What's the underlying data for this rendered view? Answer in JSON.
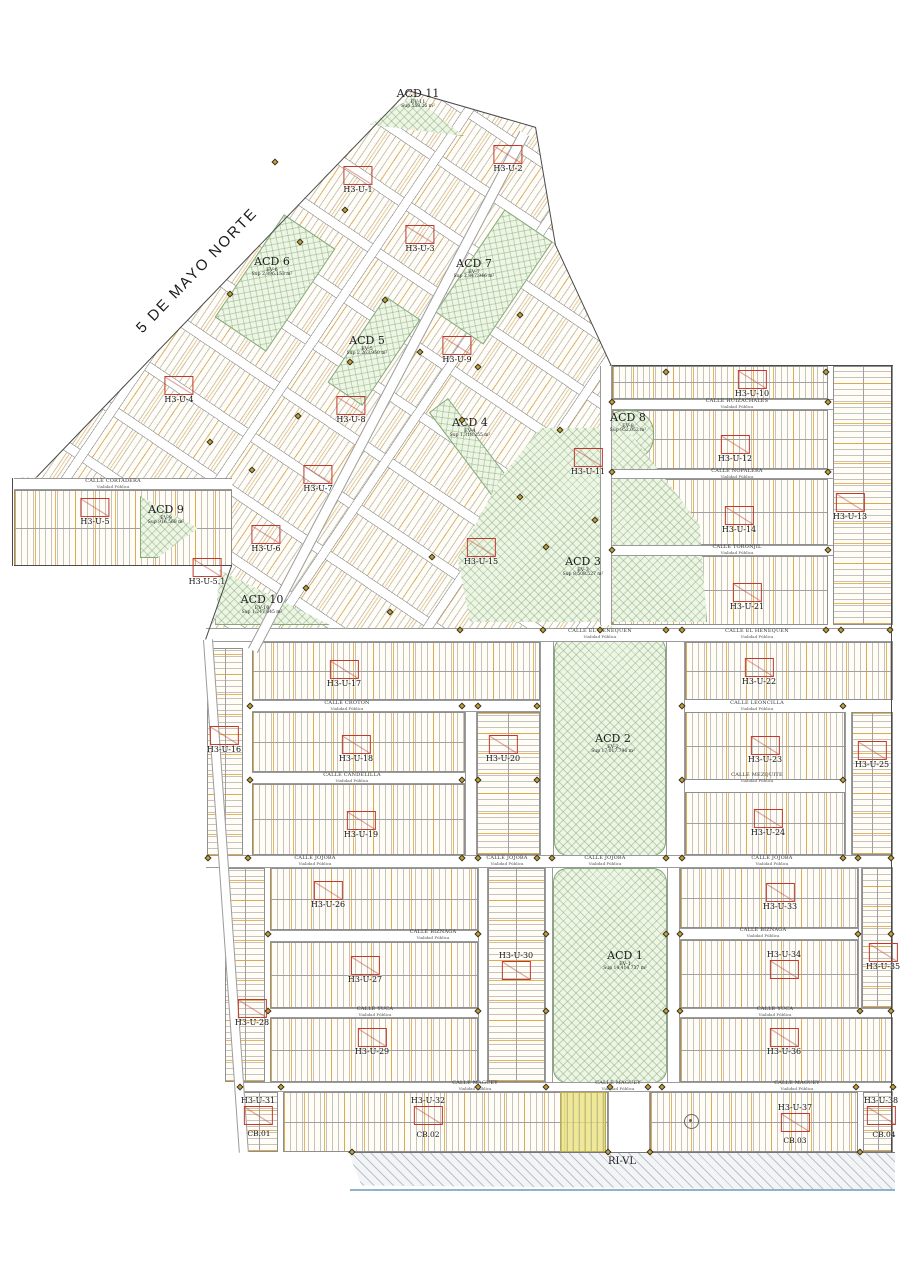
{
  "map": {
    "main_road_label": "5 DE MAYO NORTE",
    "zone_label": "RI-VL",
    "street_sub": "Vialidad Pública",
    "colors": {
      "marker_red": "#c0392b",
      "green_fill": "#edf5e4",
      "lot_orange": "#e0a33c",
      "survey_gold": "#c9a22c"
    }
  },
  "markers": [
    {
      "label": "H3-U-1",
      "x": 358,
      "y": 166,
      "p": "b"
    },
    {
      "label": "H3-U-2",
      "x": 508,
      "y": 145,
      "p": "b"
    },
    {
      "label": "H3-U-3",
      "x": 420,
      "y": 225,
      "p": "b"
    },
    {
      "label": "H3-U-4",
      "x": 179,
      "y": 376,
      "p": "b"
    },
    {
      "label": "H3-U-5",
      "x": 95,
      "y": 498,
      "p": "b"
    },
    {
      "label": "H3-U-5.1",
      "x": 207,
      "y": 558,
      "p": "b"
    },
    {
      "label": "H3-U-6",
      "x": 266,
      "y": 525,
      "p": "b"
    },
    {
      "label": "H3-U-7",
      "x": 318,
      "y": 465,
      "p": "b"
    },
    {
      "label": "H3-U-8",
      "x": 351,
      "y": 396,
      "p": "b"
    },
    {
      "label": "H3-U-9",
      "x": 457,
      "y": 336,
      "p": "b"
    },
    {
      "label": "H3-U-10",
      "x": 752,
      "y": 370,
      "p": "b"
    },
    {
      "label": "H3-U-11",
      "x": 588,
      "y": 448,
      "p": "b"
    },
    {
      "label": "H3-U-12",
      "x": 735,
      "y": 435,
      "p": "b"
    },
    {
      "label": "H3-U-13",
      "x": 850,
      "y": 493,
      "p": "b"
    },
    {
      "label": "H3-U-14",
      "x": 739,
      "y": 506,
      "p": "b"
    },
    {
      "label": "H3-U-15",
      "x": 481,
      "y": 538,
      "p": "b"
    },
    {
      "label": "H3-U-16",
      "x": 224,
      "y": 726,
      "p": "b"
    },
    {
      "label": "H3-U-17",
      "x": 344,
      "y": 660,
      "p": "b"
    },
    {
      "label": "H3-U-18",
      "x": 356,
      "y": 735,
      "p": "b"
    },
    {
      "label": "H3-U-19",
      "x": 361,
      "y": 811,
      "p": "b"
    },
    {
      "label": "H3-U-20",
      "x": 503,
      "y": 735,
      "p": "b"
    },
    {
      "label": "H3-U-21",
      "x": 747,
      "y": 583,
      "p": "b"
    },
    {
      "label": "H3-U-22",
      "x": 759,
      "y": 658,
      "p": "b"
    },
    {
      "label": "H3-U-23",
      "x": 765,
      "y": 736,
      "p": "b"
    },
    {
      "label": "H3-U-24",
      "x": 768,
      "y": 809,
      "p": "b"
    },
    {
      "label": "H3-U-25",
      "x": 872,
      "y": 741,
      "p": "b"
    },
    {
      "label": "H3-U-26",
      "x": 328,
      "y": 881,
      "p": "b"
    },
    {
      "label": "H3-U-27",
      "x": 365,
      "y": 956,
      "p": "b"
    },
    {
      "label": "H3-U-28",
      "x": 252,
      "y": 999,
      "p": "b"
    },
    {
      "label": "H3-U-29",
      "x": 372,
      "y": 1028,
      "p": "b"
    },
    {
      "label": "H3-U-30",
      "x": 516,
      "y": 963,
      "p": "a"
    },
    {
      "label": "H3-U-31",
      "x": 258,
      "y": 1108,
      "p": "a"
    },
    {
      "label": "H3-U-32",
      "x": 428,
      "y": 1108,
      "p": "a"
    },
    {
      "label": "H3-U-33",
      "x": 780,
      "y": 883,
      "p": "b"
    },
    {
      "label": "H3-U-34",
      "x": 784,
      "y": 962,
      "p": "a"
    },
    {
      "label": "H3-U-35",
      "x": 883,
      "y": 943,
      "p": "b"
    },
    {
      "label": "H3-U-36",
      "x": 784,
      "y": 1028,
      "p": "b"
    },
    {
      "label": "H3-U-37",
      "x": 795,
      "y": 1115,
      "p": "a"
    },
    {
      "label": "H3-U-38",
      "x": 881,
      "y": 1108,
      "p": "a"
    }
  ],
  "cb_labels": [
    {
      "label": "CB.01",
      "x": 259,
      "y": 1129
    },
    {
      "label": "CB.02",
      "x": 428,
      "y": 1130
    },
    {
      "label": "CB.03",
      "x": 795,
      "y": 1136
    },
    {
      "label": "CB.04",
      "x": 884,
      "y": 1130
    }
  ],
  "green_areas": [
    {
      "id": "acd-11",
      "name": "ACD 11",
      "ev": "EV-11",
      "sup": "Sup 558.26 m²",
      "x": 370,
      "y": 96,
      "w": 94,
      "h": 40,
      "cls": "g-tri11",
      "lx": 418,
      "ly": 88
    },
    {
      "id": "acd-6",
      "name": "ACD 6",
      "ev": "EV-6",
      "sup": "Sup 2,896.153 m²",
      "x": 213,
      "y": 252,
      "w": 124,
      "h": 62,
      "rot": -56,
      "lx": 272,
      "ly": 256
    },
    {
      "id": "acd-7",
      "name": "ACD 7",
      "ev": "EV-7",
      "sup": "Sup 2,847.946 m²",
      "x": 432,
      "y": 248,
      "w": 124,
      "h": 58,
      "rot": -56,
      "lx": 474,
      "ly": 258
    },
    {
      "id": "acd-5",
      "name": "ACD 5",
      "ev": "EV-5",
      "sup": "Sup 2,263.950 m²",
      "x": 322,
      "y": 330,
      "w": 104,
      "h": 42,
      "rot": -56,
      "lx": 367,
      "ly": 335
    },
    {
      "id": "acd-4",
      "name": "ACD 4",
      "ev": "EV-4",
      "sup": "Sup 1,318.255 m²",
      "x": 448,
      "y": 398,
      "w": 126,
      "h": 24,
      "rot": 53,
      "origin": "0 0",
      "lx": 470,
      "ly": 417
    },
    {
      "id": "acd-8",
      "name": "ACD 8",
      "ev": "EV-8",
      "sup": "Sup 952.052 m²",
      "x": 602,
      "y": 410,
      "w": 52,
      "h": 50,
      "cls": "g-blob",
      "lx": 628,
      "ly": 412
    },
    {
      "id": "acd-9",
      "name": "ACD 9",
      "ev": "EV-9",
      "sup": "Sup 916.568 m²",
      "x": 140,
      "y": 496,
      "w": 58,
      "h": 62,
      "cls": "g-tri9",
      "lx": 166,
      "ly": 504
    },
    {
      "id": "acd-10",
      "name": "ACD 10",
      "ev": "EV-10",
      "sup": "Sup 1,247.645 m²",
      "x": 215,
      "y": 570,
      "w": 115,
      "h": 55,
      "cls": "g-tri10",
      "lx": 262,
      "ly": 594
    },
    {
      "id": "acd-3",
      "name": "ACD 3",
      "ev": "EV-3",
      "sup": "Sup 8,508.527 m²",
      "x": 455,
      "y": 424,
      "w": 252,
      "h": 200,
      "cls": "g-poly3",
      "lx": 583,
      "ly": 556
    },
    {
      "id": "acd-2",
      "name": "ACD 2",
      "ev": "EV-2",
      "sup": "Sup 17,017.796 m²",
      "x": 554,
      "y": 636,
      "w": 112,
      "h": 220,
      "cls": "g-round",
      "lx": 613,
      "ly": 733
    },
    {
      "id": "acd-1",
      "name": "ACD 1",
      "ev": "EV-1",
      "sup": "Sup 14,414.737 m²",
      "x": 553,
      "y": 868,
      "w": 114,
      "h": 215,
      "cls": "g-round",
      "lx": 625,
      "ly": 950
    },
    {
      "id": "median",
      "name": "",
      "ev": "",
      "sup": "",
      "x": 615,
      "y": 1086,
      "w": 28,
      "h": 66,
      "cls": "g-round"
    }
  ],
  "streets": [
    {
      "name": "CALLE CORTADERA",
      "x": 113,
      "y": 484
    },
    {
      "name": "CALLE HUIZACHALES",
      "x": 737,
      "y": 404
    },
    {
      "name": "CALLE NOPALERA",
      "x": 737,
      "y": 474
    },
    {
      "name": "CALLE TORONJIL",
      "x": 737,
      "y": 550
    },
    {
      "name": "CALLE EL HENEQUEN",
      "x": 600,
      "y": 634
    },
    {
      "name": "CALLE EL HENEQUEN",
      "x": 757,
      "y": 634
    },
    {
      "name": "CALLE CROTON",
      "x": 347,
      "y": 706
    },
    {
      "name": "CALLE LEONCILLA",
      "x": 757,
      "y": 706
    },
    {
      "name": "CALLE CANDELILLA",
      "x": 352,
      "y": 778
    },
    {
      "name": "CALLE MEZQUITE",
      "x": 757,
      "y": 778
    },
    {
      "name": "CALLE JOJOBA",
      "x": 315,
      "y": 861
    },
    {
      "name": "CALLE JOJOBA",
      "x": 507,
      "y": 861
    },
    {
      "name": "CALLE JOJOBA",
      "x": 605,
      "y": 861
    },
    {
      "name": "CALLE JOJOBA",
      "x": 772,
      "y": 861
    },
    {
      "name": "CALLE BIZNAGA",
      "x": 433,
      "y": 935
    },
    {
      "name": "CALLE BIZNAGA",
      "x": 763,
      "y": 933
    },
    {
      "name": "CALLE YUCA",
      "x": 375,
      "y": 1012
    },
    {
      "name": "CALLE YUCA",
      "x": 775,
      "y": 1012
    },
    {
      "name": "CALLE MAGUEY",
      "x": 475,
      "y": 1086
    },
    {
      "name": "CALLE MAGUEY",
      "x": 618,
      "y": 1086
    },
    {
      "name": "CALLE MAGUEY",
      "x": 797,
      "y": 1086
    }
  ],
  "lots": [
    {
      "x": 612,
      "y": 366,
      "w": 216,
      "h": 33,
      "t": "v"
    },
    {
      "x": 833,
      "y": 366,
      "w": 60,
      "h": 259,
      "t": "h"
    },
    {
      "x": 612,
      "y": 410,
      "w": 216,
      "h": 59,
      "t": "v"
    },
    {
      "x": 612,
      "y": 479,
      "w": 216,
      "h": 66,
      "t": "v"
    },
    {
      "x": 612,
      "y": 556,
      "w": 216,
      "h": 69,
      "t": "v"
    },
    {
      "x": 207,
      "y": 648,
      "w": 36,
      "h": 208,
      "t": "h"
    },
    {
      "x": 252,
      "y": 642,
      "w": 288,
      "h": 58,
      "t": "v"
    },
    {
      "x": 252,
      "y": 712,
      "w": 213,
      "h": 60,
      "t": "v"
    },
    {
      "x": 477,
      "y": 712,
      "w": 63,
      "h": 143,
      "t": "h"
    },
    {
      "x": 252,
      "y": 784,
      "w": 213,
      "h": 71,
      "t": "v"
    },
    {
      "x": 685,
      "y": 642,
      "w": 208,
      "h": 58,
      "t": "v"
    },
    {
      "x": 685,
      "y": 712,
      "w": 160,
      "h": 68,
      "t": "v"
    },
    {
      "x": 852,
      "y": 712,
      "w": 41,
      "h": 143,
      "t": "h"
    },
    {
      "x": 685,
      "y": 792,
      "w": 160,
      "h": 63,
      "t": "v"
    },
    {
      "x": 225,
      "y": 868,
      "w": 40,
      "h": 214,
      "t": "h"
    },
    {
      "x": 270,
      "y": 868,
      "w": 208,
      "h": 62,
      "t": "v"
    },
    {
      "x": 270,
      "y": 942,
      "w": 208,
      "h": 66,
      "t": "v"
    },
    {
      "x": 270,
      "y": 1018,
      "w": 208,
      "h": 64,
      "t": "v"
    },
    {
      "x": 488,
      "y": 868,
      "w": 57,
      "h": 214,
      "t": "h"
    },
    {
      "x": 680,
      "y": 868,
      "w": 178,
      "h": 60,
      "t": "v"
    },
    {
      "x": 680,
      "y": 940,
      "w": 178,
      "h": 68,
      "t": "v"
    },
    {
      "x": 862,
      "y": 868,
      "w": 31,
      "h": 140,
      "t": "h"
    },
    {
      "x": 680,
      "y": 1018,
      "w": 213,
      "h": 64,
      "t": "v"
    },
    {
      "x": 240,
      "y": 1092,
      "w": 38,
      "h": 60,
      "t": "h"
    },
    {
      "x": 283,
      "y": 1092,
      "w": 325,
      "h": 60,
      "t": "v"
    },
    {
      "x": 650,
      "y": 1092,
      "w": 208,
      "h": 60,
      "t": "v"
    },
    {
      "x": 863,
      "y": 1092,
      "w": 30,
      "h": 60,
      "t": "h"
    },
    {
      "x": 14,
      "y": 490,
      "w": 218,
      "h": 76,
      "t": "v"
    }
  ],
  "street_bars": [
    {
      "x": 600,
      "y": 366,
      "w": 12,
      "h": 259,
      "o": "v"
    },
    {
      "x": 612,
      "y": 399,
      "w": 221,
      "h": 11,
      "o": "h"
    },
    {
      "x": 612,
      "y": 469,
      "w": 221,
      "h": 10,
      "o": "h"
    },
    {
      "x": 612,
      "y": 545,
      "w": 221,
      "h": 11,
      "o": "h"
    },
    {
      "x": 206,
      "y": 628,
      "w": 687,
      "h": 14,
      "o": "h"
    },
    {
      "x": 252,
      "y": 700,
      "w": 288,
      "h": 12,
      "o": "h"
    },
    {
      "x": 252,
      "y": 772,
      "w": 213,
      "h": 12,
      "o": "h"
    },
    {
      "x": 465,
      "y": 712,
      "w": 12,
      "h": 143,
      "o": "v"
    },
    {
      "x": 540,
      "y": 642,
      "w": 14,
      "h": 214,
      "o": "v"
    },
    {
      "x": 666,
      "y": 642,
      "w": 19,
      "h": 214,
      "o": "v"
    },
    {
      "x": 845,
      "y": 712,
      "w": 7,
      "h": 143,
      "o": "v"
    },
    {
      "x": 206,
      "y": 855,
      "w": 687,
      "h": 13,
      "o": "h"
    },
    {
      "x": 478,
      "y": 868,
      "w": 10,
      "h": 214,
      "o": "v"
    },
    {
      "x": 545,
      "y": 868,
      "w": 8,
      "h": 214,
      "o": "v"
    },
    {
      "x": 667,
      "y": 868,
      "w": 13,
      "h": 214,
      "o": "v"
    },
    {
      "x": 858,
      "y": 868,
      "w": 4,
      "h": 140,
      "o": "v"
    },
    {
      "x": 270,
      "y": 930,
      "w": 208,
      "h": 12,
      "o": "h"
    },
    {
      "x": 680,
      "y": 928,
      "w": 178,
      "h": 12,
      "o": "h"
    },
    {
      "x": 270,
      "y": 1008,
      "w": 208,
      "h": 10,
      "o": "h"
    },
    {
      "x": 680,
      "y": 1008,
      "w": 213,
      "h": 10,
      "o": "h"
    },
    {
      "x": 240,
      "y": 1082,
      "w": 653,
      "h": 10,
      "o": "h"
    },
    {
      "x": 608,
      "y": 1092,
      "w": 42,
      "h": 60,
      "o": "v"
    },
    {
      "x": 14,
      "y": 478,
      "w": 218,
      "h": 12,
      "o": "h"
    },
    {
      "x": 203,
      "y": 640,
      "w": 10,
      "h": 514,
      "o": "v",
      "rot": -4,
      "origin": "0 0"
    },
    {
      "x": 248,
      "y": 648,
      "w": 584,
      "h": 11,
      "o": "h",
      "rot": -62.3,
      "origin": "0 0"
    }
  ],
  "edges": [
    {
      "x": 36,
      "y": 477,
      "len": 537,
      "rot": -46.1
    },
    {
      "x": 408,
      "y": 90,
      "len": 133,
      "rot": 16.1
    },
    {
      "x": 536,
      "y": 127,
      "len": 120,
      "rot": 80.4
    },
    {
      "x": 556,
      "y": 245,
      "len": 133,
      "rot": 65.2
    },
    {
      "x": 232,
      "y": 566,
      "len": 78,
      "rot": 109.4
    },
    {
      "x": 14,
      "y": 565,
      "len": 218,
      "rot": 0
    },
    {
      "x": 13,
      "y": 478,
      "len": 88,
      "rot": 90
    },
    {
      "x": 612,
      "y": 365,
      "len": 281,
      "rot": 0
    },
    {
      "x": 892,
      "y": 366,
      "len": 786,
      "rot": 90
    }
  ],
  "dots": [
    [
      460,
      630
    ],
    [
      543,
      630
    ],
    [
      600,
      630
    ],
    [
      666,
      630
    ],
    [
      682,
      630
    ],
    [
      826,
      630
    ],
    [
      841,
      630
    ],
    [
      890,
      630
    ],
    [
      250,
      706
    ],
    [
      462,
      706
    ],
    [
      478,
      706
    ],
    [
      537,
      706
    ],
    [
      682,
      706
    ],
    [
      843,
      706
    ],
    [
      250,
      780
    ],
    [
      462,
      780
    ],
    [
      478,
      780
    ],
    [
      537,
      780
    ],
    [
      682,
      780
    ],
    [
      843,
      780
    ],
    [
      208,
      858
    ],
    [
      248,
      858
    ],
    [
      462,
      858
    ],
    [
      478,
      858
    ],
    [
      537,
      858
    ],
    [
      552,
      858
    ],
    [
      666,
      858
    ],
    [
      682,
      858
    ],
    [
      843,
      858
    ],
    [
      858,
      858
    ],
    [
      891,
      858
    ],
    [
      268,
      934
    ],
    [
      478,
      934
    ],
    [
      546,
      934
    ],
    [
      666,
      934
    ],
    [
      680,
      934
    ],
    [
      858,
      934
    ],
    [
      891,
      934
    ],
    [
      268,
      1011
    ],
    [
      478,
      1011
    ],
    [
      546,
      1011
    ],
    [
      666,
      1011
    ],
    [
      680,
      1011
    ],
    [
      860,
      1011
    ],
    [
      891,
      1011
    ],
    [
      240,
      1087
    ],
    [
      281,
      1087
    ],
    [
      478,
      1087
    ],
    [
      546,
      1087
    ],
    [
      610,
      1087
    ],
    [
      648,
      1087
    ],
    [
      662,
      1087
    ],
    [
      856,
      1087
    ],
    [
      893,
      1087
    ],
    [
      352,
      1152
    ],
    [
      608,
      1152
    ],
    [
      650,
      1152
    ],
    [
      860,
      1152
    ],
    [
      275,
      162
    ],
    [
      345,
      210
    ],
    [
      300,
      242
    ],
    [
      230,
      294
    ],
    [
      385,
      300
    ],
    [
      520,
      315
    ],
    [
      420,
      352
    ],
    [
      350,
      362
    ],
    [
      478,
      367
    ],
    [
      298,
      416
    ],
    [
      462,
      420
    ],
    [
      560,
      430
    ],
    [
      210,
      442
    ],
    [
      252,
      470
    ],
    [
      520,
      497
    ],
    [
      595,
      520
    ],
    [
      546,
      547
    ],
    [
      432,
      557
    ],
    [
      306,
      588
    ],
    [
      390,
      612
    ],
    [
      612,
      402
    ],
    [
      828,
      402
    ],
    [
      612,
      472
    ],
    [
      828,
      472
    ],
    [
      612,
      550
    ],
    [
      828,
      550
    ],
    [
      666,
      372
    ],
    [
      826,
      372
    ]
  ]
}
